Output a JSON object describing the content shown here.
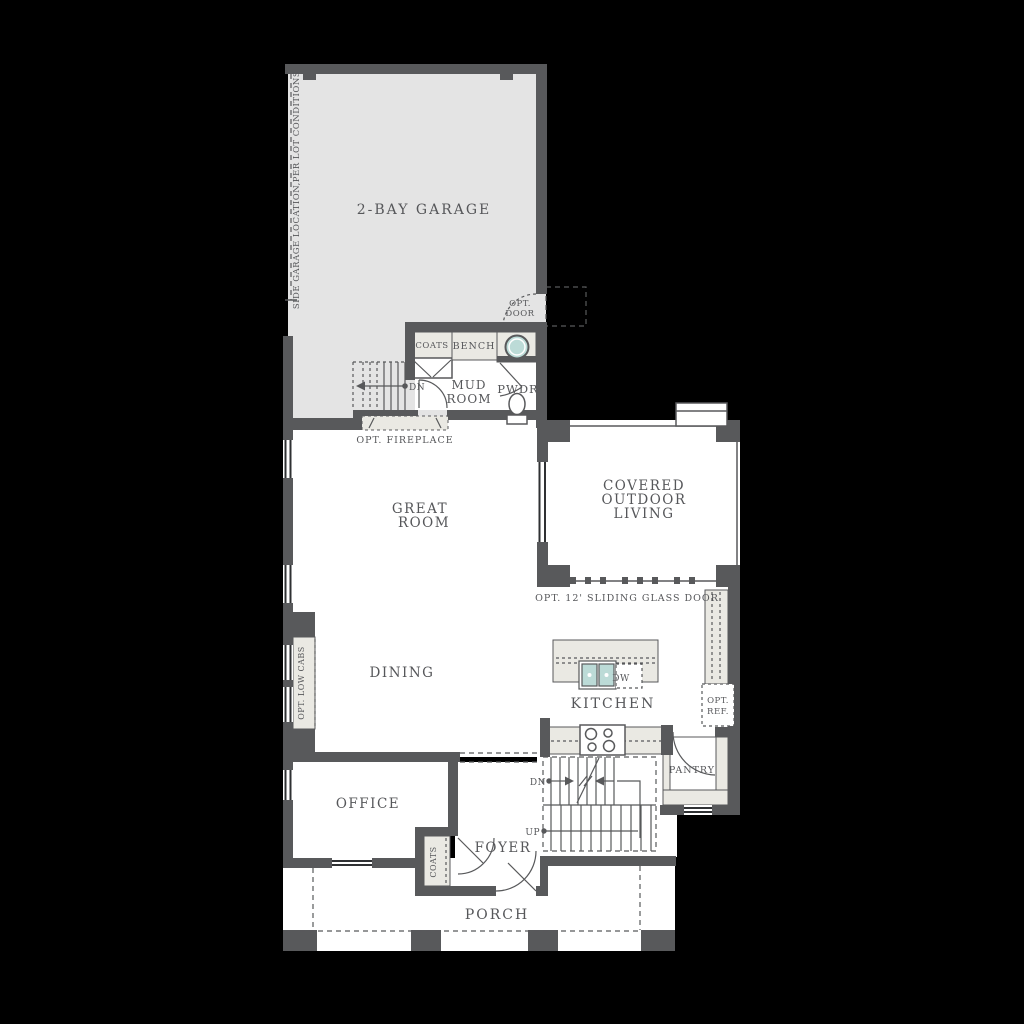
{
  "colors": {
    "background": "#000000",
    "wall": "#58595b",
    "room": "#ffffff",
    "garage": "#e4e4e4",
    "counter": "#eae9e3",
    "sink": "#bcdbd7",
    "text": "#56575a",
    "window": "#2f3133"
  },
  "rooms": {
    "garage": {
      "label": "2-BAY GARAGE"
    },
    "great_room": {
      "line1": "GREAT",
      "line2": "ROOM"
    },
    "dining": {
      "label": "DINING"
    },
    "kitchen": {
      "label": "KITCHEN"
    },
    "covered_outdoor_living": {
      "line1": "COVERED",
      "line2": "OUTDOOR",
      "line3": "LIVING"
    },
    "mud_room": {
      "line1": "MUD",
      "line2": "ROOM"
    },
    "powder": {
      "label": "PWDR"
    },
    "office": {
      "label": "OFFICE"
    },
    "foyer": {
      "label": "FOYER"
    },
    "pantry": {
      "label": "PANTRY"
    },
    "porch": {
      "label": "PORCH"
    }
  },
  "annotations": {
    "side_garage_note": "SIDE GARAGE LOCATION,PER LOT CONDITIONS",
    "opt_door": {
      "line1": "OPT.",
      "line2": "DOOR"
    },
    "mud_coats": "COATS",
    "bench": "BENCH",
    "opt_fireplace": "OPT. FIREPLACE",
    "sliding_glass_door": "OPT. 12' SLIDING GLASS DOOR",
    "opt_low_cabs": "OPT. LOW CABS",
    "dishwasher": "DW",
    "opt_ref": {
      "line1": "OPT.",
      "line2": "REF."
    },
    "garage_stairs_dn": "DN",
    "stairs_dn": "DN",
    "stairs_up": "UP",
    "foyer_coats": "COATS"
  }
}
